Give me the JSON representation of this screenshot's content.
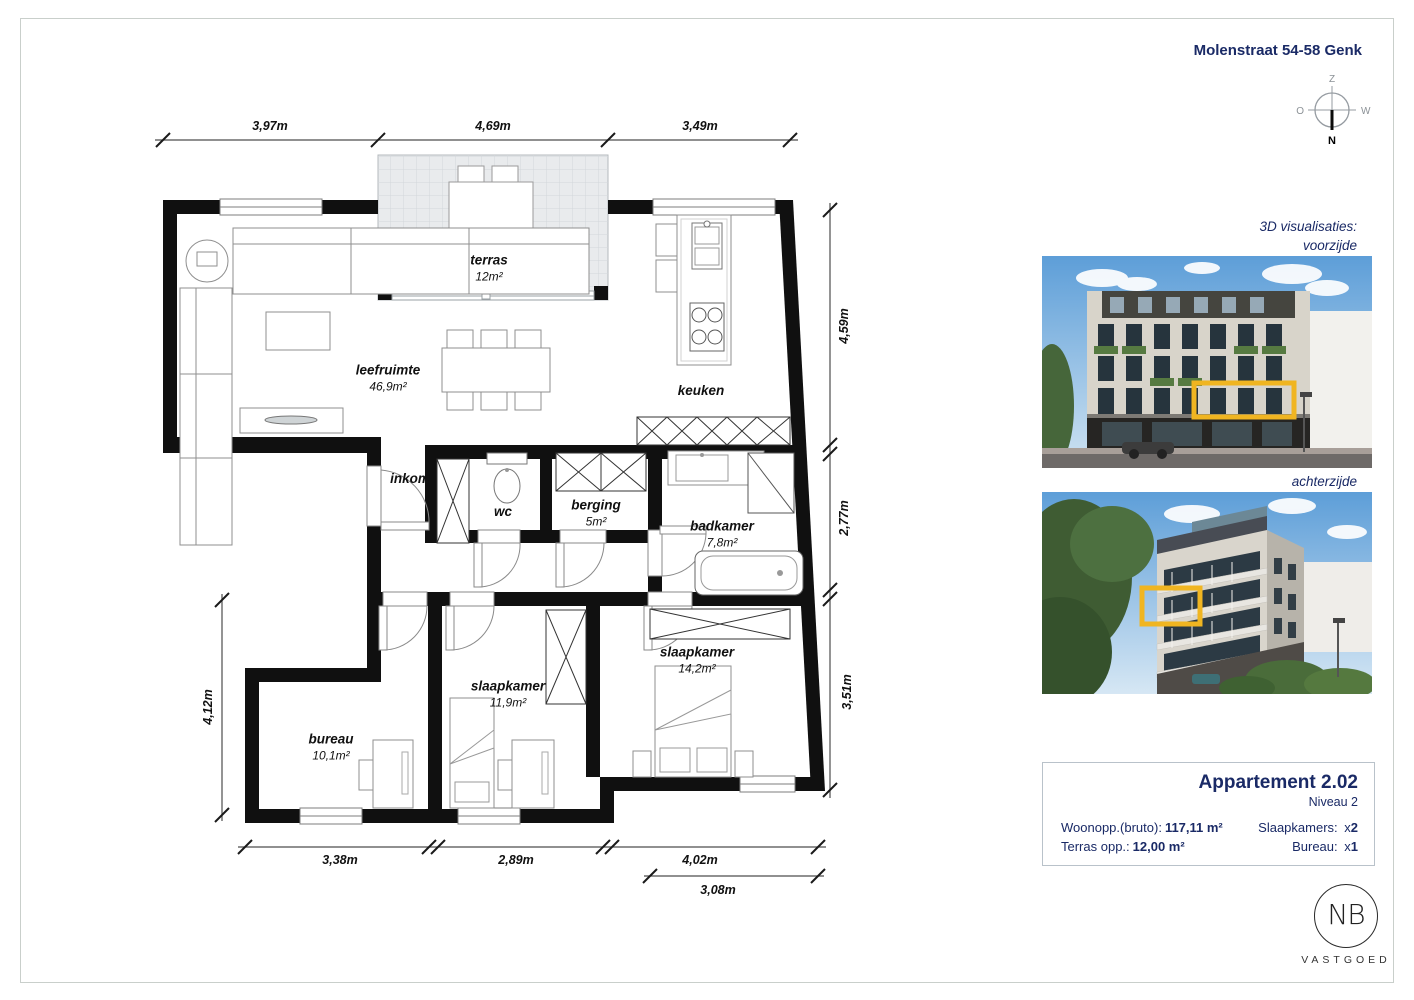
{
  "page": {
    "title": "Molenstraat 54-58 Genk"
  },
  "compass": {
    "south": "Z",
    "west": "W",
    "east": "O",
    "north": "N"
  },
  "floor_plan": {
    "rooms": [
      {
        "name": "terras",
        "area": "12m²"
      },
      {
        "name": "leefruimte",
        "area": "46,9m²"
      },
      {
        "name": "keuken",
        "area": ""
      },
      {
        "name": "inkom",
        "area": ""
      },
      {
        "name": "wc",
        "area": ""
      },
      {
        "name": "berging",
        "area": "5m²"
      },
      {
        "name": "badkamer",
        "area": "7,8m²"
      },
      {
        "name": "slaapkamer",
        "area": "14,2m²"
      },
      {
        "name": "slaapkamer",
        "area": "11,9m²"
      },
      {
        "name": "bureau",
        "area": "10,1m²"
      }
    ],
    "dimensions": {
      "top": [
        "3,97m",
        "4,69m",
        "3,49m"
      ],
      "right": [
        "4,59m",
        "2,77m",
        "3,51m"
      ],
      "left": [
        "4,12m"
      ],
      "bottom": [
        "3,38m",
        "2,89m",
        "4,02m"
      ],
      "bottom_secondary": [
        "3,08m"
      ]
    }
  },
  "visualisations": {
    "heading": "3D visualisaties:",
    "front_label": "voorzijde",
    "back_label": "achterzijde"
  },
  "info_box": {
    "title": "Appartement 2.02",
    "subtitle": "Niveau 2",
    "fields_left": [
      {
        "label": "Woonopp.(bruto):",
        "value": "117,11 m²"
      },
      {
        "label": "Terras opp.:",
        "value": "12,00 m²"
      }
    ],
    "fields_right": [
      {
        "label": "Slaapkamers:",
        "x": "x",
        "value": "2"
      },
      {
        "label": "Bureau:",
        "x": "x",
        "value": "1"
      }
    ]
  },
  "logo": {
    "initials": "NB",
    "text": "VASTGOED"
  },
  "colors": {
    "accent": "#f0b521",
    "navy": "#1a2a66",
    "wall": "#101010"
  }
}
